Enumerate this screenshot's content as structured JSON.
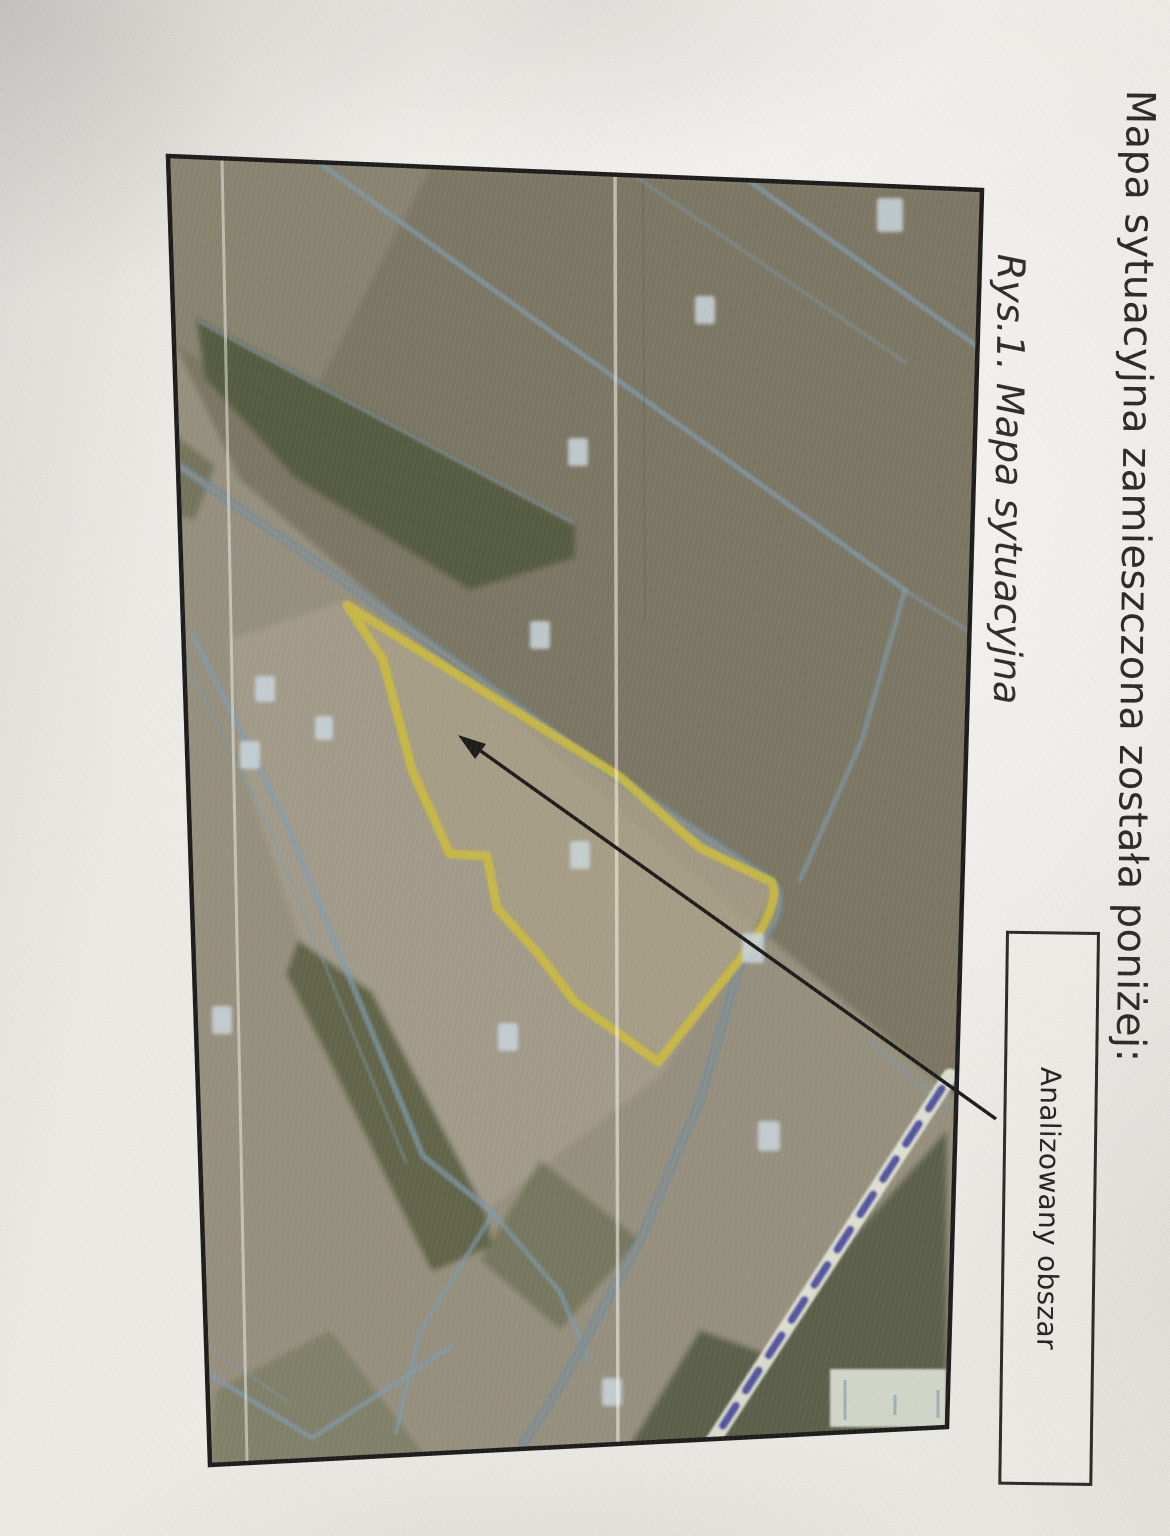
{
  "document": {
    "heading": "Mapa sytuacyjna zamieszczona została poniżej:",
    "figure": {
      "caption": "Rys.1. Mapa sytuacyjna",
      "callout_label": "Analizowany obszar"
    }
  },
  "map": {
    "colors": {
      "analyzed_area_outline": "#ccbc40",
      "parcel_boundaries": "#7f9cb0",
      "marked_route_dashes": "#3f429b",
      "forest": "#575b41",
      "field_base": "#97907e",
      "frame": "#1c1c1c"
    }
  }
}
